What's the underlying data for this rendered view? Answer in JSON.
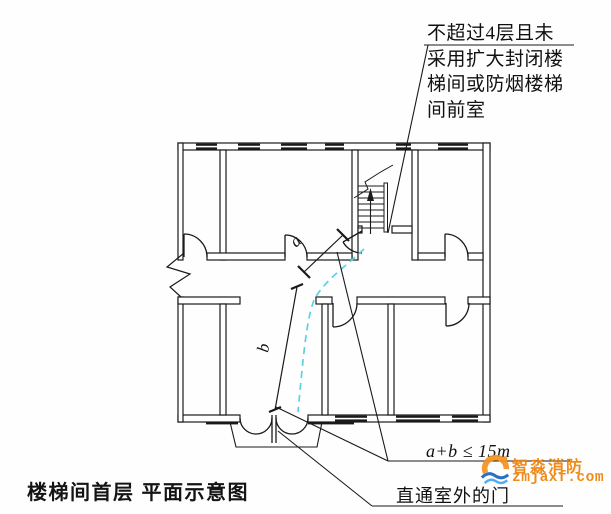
{
  "figure": {
    "caption": "楼梯间首层 平面示意图",
    "type": "fire-code stairwell first-floor plan schematic"
  },
  "callouts": {
    "stair_note_lines": [
      "不超过4层且未",
      "采用扩大封闭楼",
      "梯间或防烟楼梯",
      "间前室"
    ],
    "distance_rule": "a+b ≤ 15m",
    "exit_door_note": "直通室外的门"
  },
  "dimensions": {
    "a_label": "a",
    "b_label": "b"
  },
  "stairs": {
    "direction": "up",
    "symbol": "flight-with-break-line-and-up-arrow"
  },
  "colors": {
    "line": "#1a1a1a",
    "escape_path": "#5ad2e4",
    "watermark_orange": "#ee8206",
    "watermark_blue": "#1565c0",
    "background": "#fefefe"
  },
  "watermark": {
    "brand": "智淼消防",
    "domain": "zmjaxf.com"
  }
}
